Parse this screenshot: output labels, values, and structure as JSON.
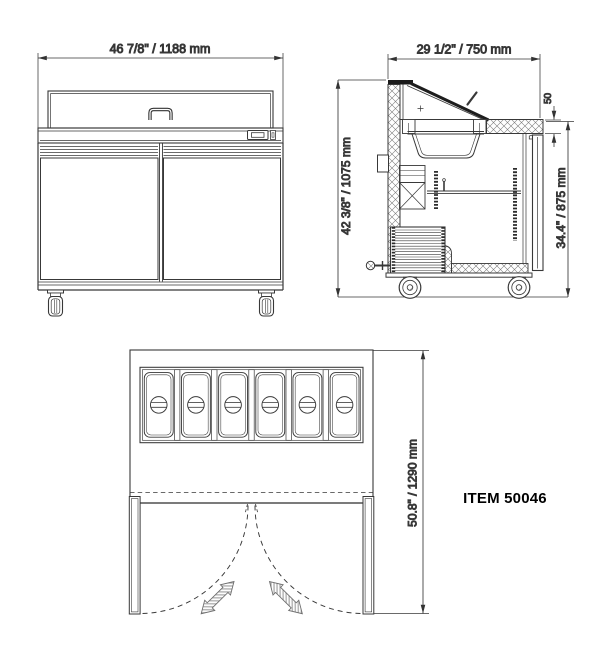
{
  "drawing": {
    "item_label": "ITEM 50046",
    "front_view": {
      "width_dim": "46 7/8\" / 1188 mm"
    },
    "side_view": {
      "depth_dim": "29 1/2\" / 750 mm",
      "overall_height_dim": "42 3/8\" / 1075 mm",
      "counter_height_dim": "34.4\" / 875 mm",
      "counter_thickness_dim": "50"
    },
    "plan_view": {
      "depth_doors_open_dim": "50.8\" / 1290 mm",
      "pan_count": 6
    },
    "colors": {
      "line": "#383838",
      "text": "#1c1c1c",
      "background": "#ffffff"
    }
  }
}
